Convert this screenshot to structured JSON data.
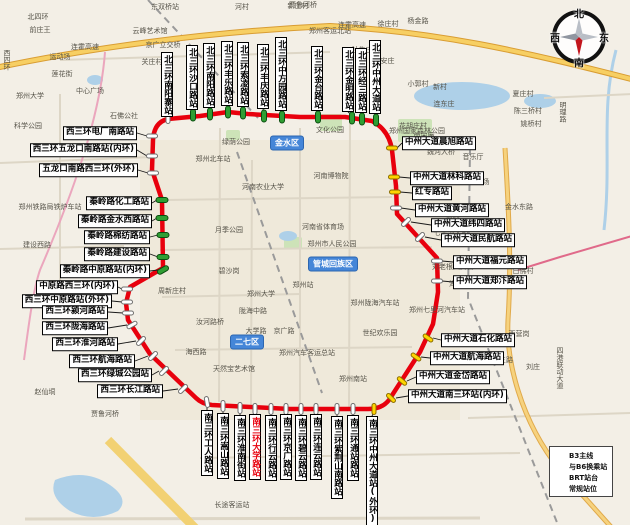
{
  "compass": {
    "north": "北",
    "south": "南",
    "east": "东",
    "west": "西"
  },
  "legend": {
    "items": [
      {
        "type": "line",
        "label": "B3主线"
      },
      {
        "type": "transfer",
        "label": "与B6换乘站"
      },
      {
        "type": "platform",
        "label": "BRT站台"
      },
      {
        "type": "regular",
        "label": "常规站位"
      }
    ]
  },
  "colors": {
    "route": "#e8000d",
    "transfer_station": "#2f9e33",
    "regular_stop": "#ffd400",
    "brt_platform": "#ffffff"
  },
  "districts": [
    {
      "name": "金水区",
      "x": 287,
      "y": 143
    },
    {
      "name": "管城回族区",
      "x": 333,
      "y": 264
    },
    {
      "name": "二七区",
      "x": 247,
      "y": 342
    }
  ],
  "stations": {
    "north": [
      {
        "name": "北三环南阳寨站",
        "x": 161,
        "b": 117,
        "mx": 168,
        "my": 118,
        "c": "w",
        "a": 90
      },
      {
        "name": "北三环沙口路站",
        "x": 186,
        "b": 110,
        "mx": 193,
        "my": 115,
        "c": "g",
        "a": 90
      },
      {
        "name": "北三环南阳路站",
        "x": 203,
        "b": 108,
        "mx": 210,
        "my": 114,
        "c": "g",
        "a": 90
      },
      {
        "name": "北三环丰乐路站",
        "x": 221,
        "b": 106,
        "mx": 228,
        "my": 112,
        "c": "g",
        "a": 90
      },
      {
        "name": "北三环索凌路站",
        "x": 237,
        "b": 107,
        "mx": 243,
        "my": 113,
        "c": "g",
        "a": 90
      },
      {
        "name": "北三环丰庆路站",
        "x": 257,
        "b": 109,
        "mx": 264,
        "my": 116,
        "c": "g",
        "a": 90
      },
      {
        "name": "北三环中方园路站",
        "x": 275,
        "b": 111,
        "mx": 282,
        "my": 117,
        "c": "g",
        "a": 90
      },
      {
        "name": "北三环金台路站",
        "x": 311,
        "b": 111,
        "mx": 318,
        "my": 117,
        "c": "g",
        "a": 90
      },
      {
        "name": "北三环金明路站",
        "x": 342,
        "b": 112,
        "mx": 352,
        "my": 118,
        "c": "g",
        "a": 90
      },
      {
        "name": "北三环经三路站",
        "x": 355,
        "b": 113,
        "mx": 362,
        "my": 119,
        "c": "g",
        "a": 90
      },
      {
        "name": "北三环中州大道站",
        "x": 369,
        "b": 114,
        "mx": 376,
        "my": 120,
        "c": "g",
        "a": 90
      }
    ],
    "east": [
      {
        "name": "中州大道晨旭路站",
        "l": 402,
        "y": 143,
        "mx": 392,
        "my": 148,
        "c": "y",
        "a": 0
      },
      {
        "name": "中州大道林科路站",
        "l": 410,
        "y": 178,
        "mx": 394,
        "my": 177,
        "c": "y",
        "a": 0
      },
      {
        "name": "红专路站",
        "l": 412,
        "y": 193,
        "mx": 395,
        "my": 192,
        "c": "y",
        "a": 0
      },
      {
        "name": "中州大道黄河路站",
        "l": 415,
        "y": 210,
        "mx": 396,
        "my": 208,
        "c": "w",
        "a": 0
      },
      {
        "name": "中州大道纬四路站",
        "l": 431,
        "y": 225,
        "mx": 406,
        "my": 222,
        "c": "w",
        "a": -45
      },
      {
        "name": "中州大道民航路站",
        "l": 441,
        "y": 240,
        "mx": 420,
        "my": 237,
        "c": "w",
        "a": -45
      },
      {
        "name": "中州大道福元路站",
        "l": 453,
        "y": 262,
        "mx": 437,
        "my": 261,
        "c": "w",
        "a": 0
      },
      {
        "name": "中州大道郑汴路站",
        "l": 453,
        "y": 282,
        "mx": 437,
        "my": 281,
        "c": "w",
        "a": 0
      },
      {
        "name": "中州大道石化路站",
        "l": 441,
        "y": 340,
        "mx": 428,
        "my": 338,
        "c": "y",
        "a": 35
      },
      {
        "name": "中州大道航海路站",
        "l": 430,
        "y": 358,
        "mx": 416,
        "my": 357,
        "c": "y",
        "a": 35
      },
      {
        "name": "中州大道金岱路站",
        "l": 416,
        "y": 377,
        "mx": 402,
        "my": 381,
        "c": "y",
        "a": 40
      },
      {
        "name": "中州大道南三环站(内环)",
        "l": 408,
        "y": 396,
        "mx": 391,
        "my": 398,
        "c": "y",
        "a": 45
      }
    ],
    "south": [
      {
        "name": "南三环工人路站",
        "x": 201,
        "t": 410,
        "mx": 207,
        "my": 402,
        "c": "w",
        "a": 80
      },
      {
        "name": "南三环嵩山路站",
        "x": 217,
        "t": 413,
        "mx": 223,
        "my": 406,
        "c": "w",
        "a": 90
      },
      {
        "name": "南三环淮南街站",
        "x": 234,
        "t": 415,
        "mx": 240,
        "my": 408,
        "c": "w",
        "a": 90
      },
      {
        "name": "南三环大学路站",
        "x": 249,
        "t": 414,
        "mx": 255,
        "my": 409,
        "c": "w",
        "a": 90,
        "hl": true
      },
      {
        "name": "南三环行云路站",
        "x": 265,
        "t": 415,
        "mx": 271,
        "my": 409,
        "c": "w",
        "a": 90
      },
      {
        "name": "南三环京广路站",
        "x": 280,
        "t": 414,
        "mx": 286,
        "my": 409,
        "c": "w",
        "a": 90
      },
      {
        "name": "南三环碧云路站",
        "x": 295,
        "t": 415,
        "mx": 301,
        "my": 409,
        "c": "w",
        "a": 90
      },
      {
        "name": "南三环连云路站",
        "x": 310,
        "t": 414,
        "mx": 316,
        "my": 409,
        "c": "w",
        "a": 90
      },
      {
        "name": "南三环紫荆山南路站",
        "x": 331,
        "t": 416,
        "mx": 337,
        "my": 409,
        "c": "w",
        "a": 90
      },
      {
        "name": "南三环通站路站",
        "x": 347,
        "t": 415,
        "mx": 353,
        "my": 409,
        "c": "w",
        "a": 90
      },
      {
        "name": "南三环中州大道站(外环)",
        "x": 366,
        "t": 416,
        "mx": 374,
        "my": 409,
        "c": "y",
        "a": 90
      }
    ],
    "west": [
      {
        "name": "西三环电厂南路站",
        "r": 137,
        "y": 133,
        "mx": 152,
        "my": 136,
        "c": "w",
        "a": 0
      },
      {
        "name": "西三环五龙口南路站(内环)",
        "r": 137,
        "y": 150,
        "mx": 152,
        "my": 156,
        "c": "w",
        "a": 0
      },
      {
        "name": "五龙口南路西三环(外环)",
        "r": 138,
        "y": 170,
        "mx": 153,
        "my": 173,
        "c": "w",
        "a": 0
      },
      {
        "name": "秦岭路化工路站",
        "r": 152,
        "y": 203,
        "mx": 162,
        "my": 200,
        "c": "g",
        "a": 0
      },
      {
        "name": "秦岭路金水西路站",
        "r": 152,
        "y": 221,
        "mx": 162,
        "my": 218,
        "c": "g",
        "a": 0
      },
      {
        "name": "秦岭路棉纺路站",
        "r": 150,
        "y": 237,
        "mx": 163,
        "my": 235,
        "c": "g",
        "a": 0
      },
      {
        "name": "秦岭路建设路站",
        "r": 150,
        "y": 254,
        "mx": 163,
        "my": 257,
        "c": "g",
        "a": 0
      },
      {
        "name": "秦岭路中原路站(内环)",
        "r": 150,
        "y": 271,
        "mx": 163,
        "my": 270,
        "c": "g",
        "a": -30
      },
      {
        "name": "中原路西三环(内环)",
        "r": 118,
        "y": 287,
        "mx": 127,
        "my": 289,
        "c": "w",
        "a": 0
      },
      {
        "name": "西三环中原路站(外环)",
        "r": 112,
        "y": 301,
        "mx": 127,
        "my": 302,
        "c": "w",
        "a": 0
      },
      {
        "name": "西三环颍河路站",
        "r": 108,
        "y": 312,
        "mx": 128,
        "my": 313,
        "c": "w",
        "a": 0
      },
      {
        "name": "西三环陇海路站",
        "r": 108,
        "y": 328,
        "mx": 132,
        "my": 325,
        "c": "w",
        "a": -30
      },
      {
        "name": "西三环淮河路站",
        "r": 118,
        "y": 344,
        "mx": 141,
        "my": 341,
        "c": "w",
        "a": -45
      },
      {
        "name": "西三环航海路站",
        "r": 135,
        "y": 361,
        "mx": 153,
        "my": 356,
        "c": "w",
        "a": -45
      },
      {
        "name": "西三环绿城公园站",
        "r": 152,
        "y": 375,
        "mx": 164,
        "my": 371,
        "c": "w",
        "a": -45
      },
      {
        "name": "西三环长江路站",
        "r": 163,
        "y": 391,
        "mx": 183,
        "my": 389,
        "c": "w",
        "a": -45
      }
    ]
  },
  "map_labels": [
    {
      "t": "北四环",
      "x": 38,
      "y": 17
    },
    {
      "t": "东双桥站",
      "x": 165,
      "y": 7
    },
    {
      "t": "贾鲁河桥",
      "x": 303,
      "y": 5
    },
    {
      "t": "连霍高速",
      "x": 85,
      "y": 47
    },
    {
      "t": "连霍高速",
      "x": 352,
      "y": 25
    },
    {
      "t": "云峰艺术馆",
      "x": 150,
      "y": 31
    },
    {
      "t": "京广立交桥",
      "x": 163,
      "y": 45
    },
    {
      "t": "关庄村",
      "x": 152,
      "y": 62
    },
    {
      "t": "前庄王",
      "x": 40,
      "y": 30
    },
    {
      "t": "西四环",
      "x": 7,
      "y": 60,
      "v": true
    },
    {
      "t": "运动场",
      "x": 60,
      "y": 57
    },
    {
      "t": "莲花街",
      "x": 62,
      "y": 74
    },
    {
      "t": "中心广场",
      "x": 90,
      "y": 91
    },
    {
      "t": "郑州大学",
      "x": 30,
      "y": 96
    },
    {
      "t": "科学公园",
      "x": 28,
      "y": 126
    },
    {
      "t": "石佛公社",
      "x": 124,
      "y": 116
    },
    {
      "t": "郑州客运北站",
      "x": 330,
      "y": 31
    },
    {
      "t": "河村",
      "x": 242,
      "y": 7
    },
    {
      "t": "新庄村",
      "x": 298,
      "y": 6
    },
    {
      "t": "徐庄村",
      "x": 388,
      "y": 24
    },
    {
      "t": "杨金路",
      "x": 418,
      "y": 21
    },
    {
      "t": "牡牛庄",
      "x": 362,
      "y": 50
    },
    {
      "t": "北安庄",
      "x": 384,
      "y": 61
    },
    {
      "t": "小郭村",
      "x": 418,
      "y": 84
    },
    {
      "t": "新村",
      "x": 440,
      "y": 87
    },
    {
      "t": "连东庄",
      "x": 444,
      "y": 104
    },
    {
      "t": "花胡庄村",
      "x": 413,
      "y": 126
    },
    {
      "t": "南宋庵",
      "x": 424,
      "y": 136
    },
    {
      "t": "郑州国家森林公园",
      "x": 417,
      "y": 131
    },
    {
      "t": "夏庄村",
      "x": 523,
      "y": 94
    },
    {
      "t": "陈三桥村",
      "x": 528,
      "y": 111
    },
    {
      "t": "姚桥村",
      "x": 531,
      "y": 124
    },
    {
      "t": "明理路",
      "x": 563,
      "y": 112,
      "v": true
    },
    {
      "t": "魏河大桥",
      "x": 441,
      "y": 152
    },
    {
      "t": "音乐厅",
      "x": 473,
      "y": 157
    },
    {
      "t": "网球场",
      "x": 479,
      "y": 182
    },
    {
      "t": "文化公园",
      "x": 330,
      "y": 130
    },
    {
      "t": "绿荫公园",
      "x": 236,
      "y": 142
    },
    {
      "t": "郑州北车站",
      "x": 213,
      "y": 159
    },
    {
      "t": "河南农业大学",
      "x": 263,
      "y": 187
    },
    {
      "t": "河南博物院",
      "x": 331,
      "y": 176
    },
    {
      "t": "金水东路",
      "x": 519,
      "y": 207
    },
    {
      "t": "新村",
      "x": 453,
      "y": 217
    },
    {
      "t": "月季公园",
      "x": 229,
      "y": 230
    },
    {
      "t": "河南省体育场",
      "x": 323,
      "y": 227
    },
    {
      "t": "郑州市人民公园",
      "x": 332,
      "y": 244
    },
    {
      "t": "七里河大桥",
      "x": 451,
      "y": 233
    },
    {
      "t": "碧沙岗",
      "x": 229,
      "y": 271
    },
    {
      "t": "刘老根大舞台",
      "x": 453,
      "y": 267
    },
    {
      "t": "白佛村",
      "x": 523,
      "y": 271
    },
    {
      "t": "海马公园",
      "x": 463,
      "y": 284
    },
    {
      "t": "周新庄村",
      "x": 172,
      "y": 291
    },
    {
      "t": "郑州大学",
      "x": 261,
      "y": 294
    },
    {
      "t": "郑州站",
      "x": 303,
      "y": 285
    },
    {
      "t": "陇海中路",
      "x": 253,
      "y": 311
    },
    {
      "t": "郑州陇海汽车站",
      "x": 375,
      "y": 303
    },
    {
      "t": "郑州七里河汽车站",
      "x": 437,
      "y": 310
    },
    {
      "t": "汝河路桥",
      "x": 210,
      "y": 322
    },
    {
      "t": "大学路",
      "x": 256,
      "y": 331
    },
    {
      "t": "京广路",
      "x": 284,
      "y": 331
    },
    {
      "t": "世纪欢乐园",
      "x": 380,
      "y": 333
    },
    {
      "t": "西营岗",
      "x": 519,
      "y": 334
    },
    {
      "t": "海西路",
      "x": 196,
      "y": 352
    },
    {
      "t": "郑州汽车客运总站",
      "x": 307,
      "y": 353
    },
    {
      "t": "天然宝艺术馆",
      "x": 234,
      "y": 369
    },
    {
      "t": "泾南三路",
      "x": 499,
      "y": 360
    },
    {
      "t": "刘庄",
      "x": 533,
      "y": 367
    },
    {
      "t": "四港联动大道",
      "x": 560,
      "y": 368,
      "v": true
    },
    {
      "t": "郑州南站",
      "x": 353,
      "y": 379
    },
    {
      "t": "赵仙垌",
      "x": 45,
      "y": 392
    },
    {
      "t": "贾鲁河桥",
      "x": 105,
      "y": 414
    },
    {
      "t": "建设西路",
      "x": 37,
      "y": 245
    },
    {
      "t": "郑州铁路局铁炉车站",
      "x": 50,
      "y": 207
    },
    {
      "t": "长途客运站",
      "x": 232,
      "y": 505
    }
  ]
}
